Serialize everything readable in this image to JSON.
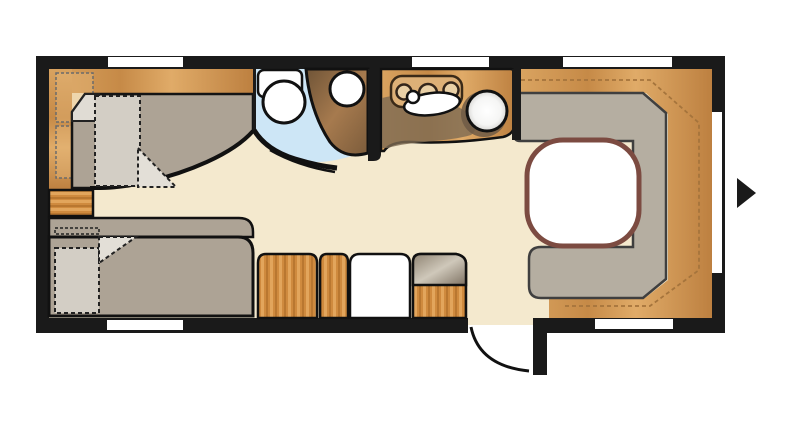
{
  "scene": {
    "type": "caravan-floor-plan",
    "orientation_arrow": "right"
  },
  "colors": {
    "background": "#ffffff",
    "wall": "#1a1a1a",
    "floor": "#f4e9ce",
    "mattress": "#ada395",
    "cushion": "#b5aea1",
    "bedding": "#d3cec5",
    "pillow": "#e0dcd4",
    "shower": "#cde6f6",
    "fixture_white": "#ffffff",
    "table_fill": "#ffffff",
    "table_border": "#7c4b41",
    "stitch": "#a5743c",
    "dark_counter": "#7d6a52",
    "window": "#ffffff"
  },
  "rooms": {
    "bedroom": {
      "name": "twin-bed-bedroom",
      "items": [
        "single-bed-top",
        "single-bed-bottom",
        "overhead-locker-1",
        "overhead-locker-2",
        "bedside-drawer-unit"
      ]
    },
    "bathroom": {
      "name": "washroom",
      "items": [
        "shower-cubicle",
        "washbasin",
        "toilet"
      ]
    },
    "kitchen": {
      "name": "kitchen",
      "items": [
        "three-burner-hob",
        "sink-oval",
        "sink-bowl",
        "faucet"
      ]
    },
    "lounge": {
      "name": "u-shaped-dinette",
      "items": [
        "u-sofa",
        "table"
      ]
    },
    "entry": {
      "items": [
        "entrance-door",
        "cabinet-1",
        "cabinet-2",
        "fridge",
        "worktop-unit"
      ]
    }
  },
  "openings": {
    "windows_top": 3,
    "windows_bottom": 2,
    "windows_right": 1,
    "door": "bottom-right-opens-outward"
  }
}
